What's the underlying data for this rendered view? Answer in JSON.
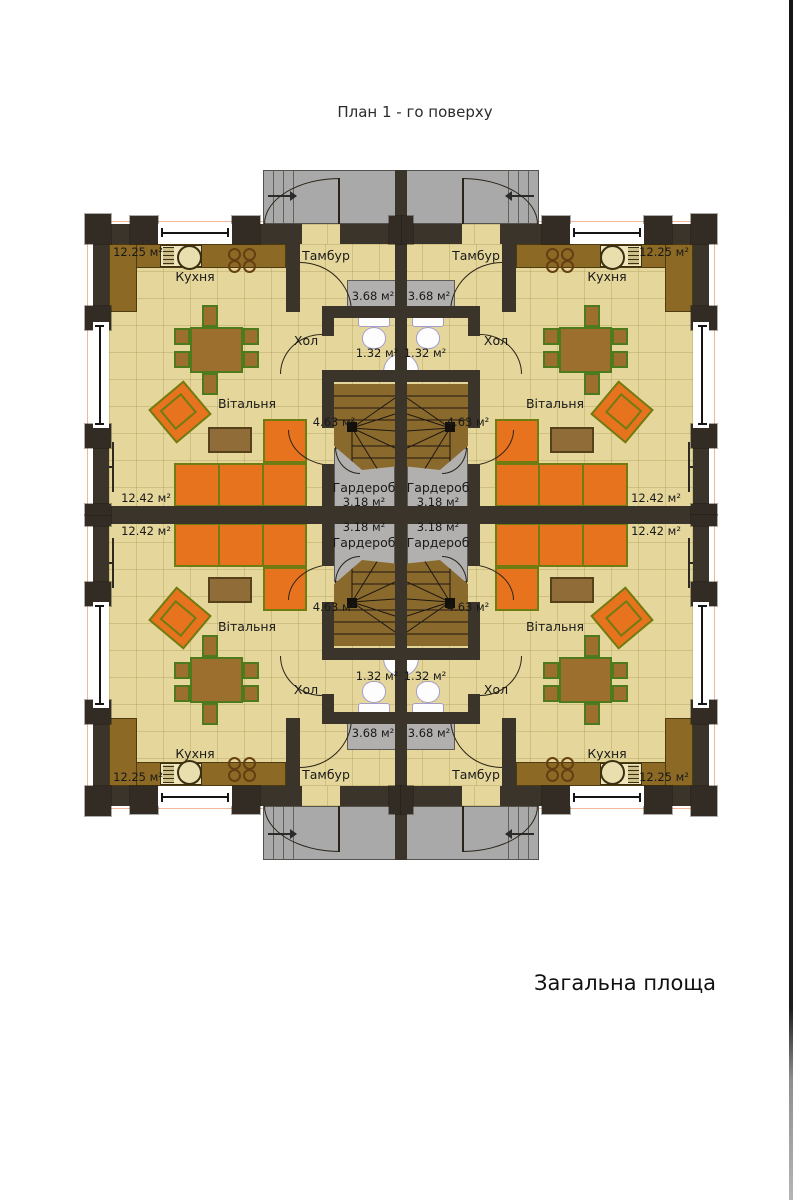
{
  "page": {
    "title": "План 1 - го поверху",
    "footer": "Загальна площа"
  },
  "unit": {
    "kitchen": {
      "label": "Кухня",
      "area": "12.25 м²"
    },
    "living": {
      "label": "Вітальня",
      "area": "12.42 м²"
    },
    "tambour": {
      "label": "Тамбур",
      "area": "3.68 м²"
    },
    "hall": {
      "label": "Хол",
      "area": "1.32 м²"
    },
    "stairs": {
      "area": "4.63 м²"
    },
    "wardrobe": {
      "label": "Гардероб",
      "area": "3.18 м²"
    }
  },
  "colors": {
    "wall": "#3b342b",
    "floor": "#e5d79b",
    "counter": "#8c6a26",
    "sofa": "#e8731e",
    "furniture_outline": "#4e7a1e",
    "porch": "#a9a9a9",
    "wardrobe_gray": "#b1b0ae",
    "stairs": "#8a6a2c",
    "roof_overhang_line": "#f0b79b"
  }
}
